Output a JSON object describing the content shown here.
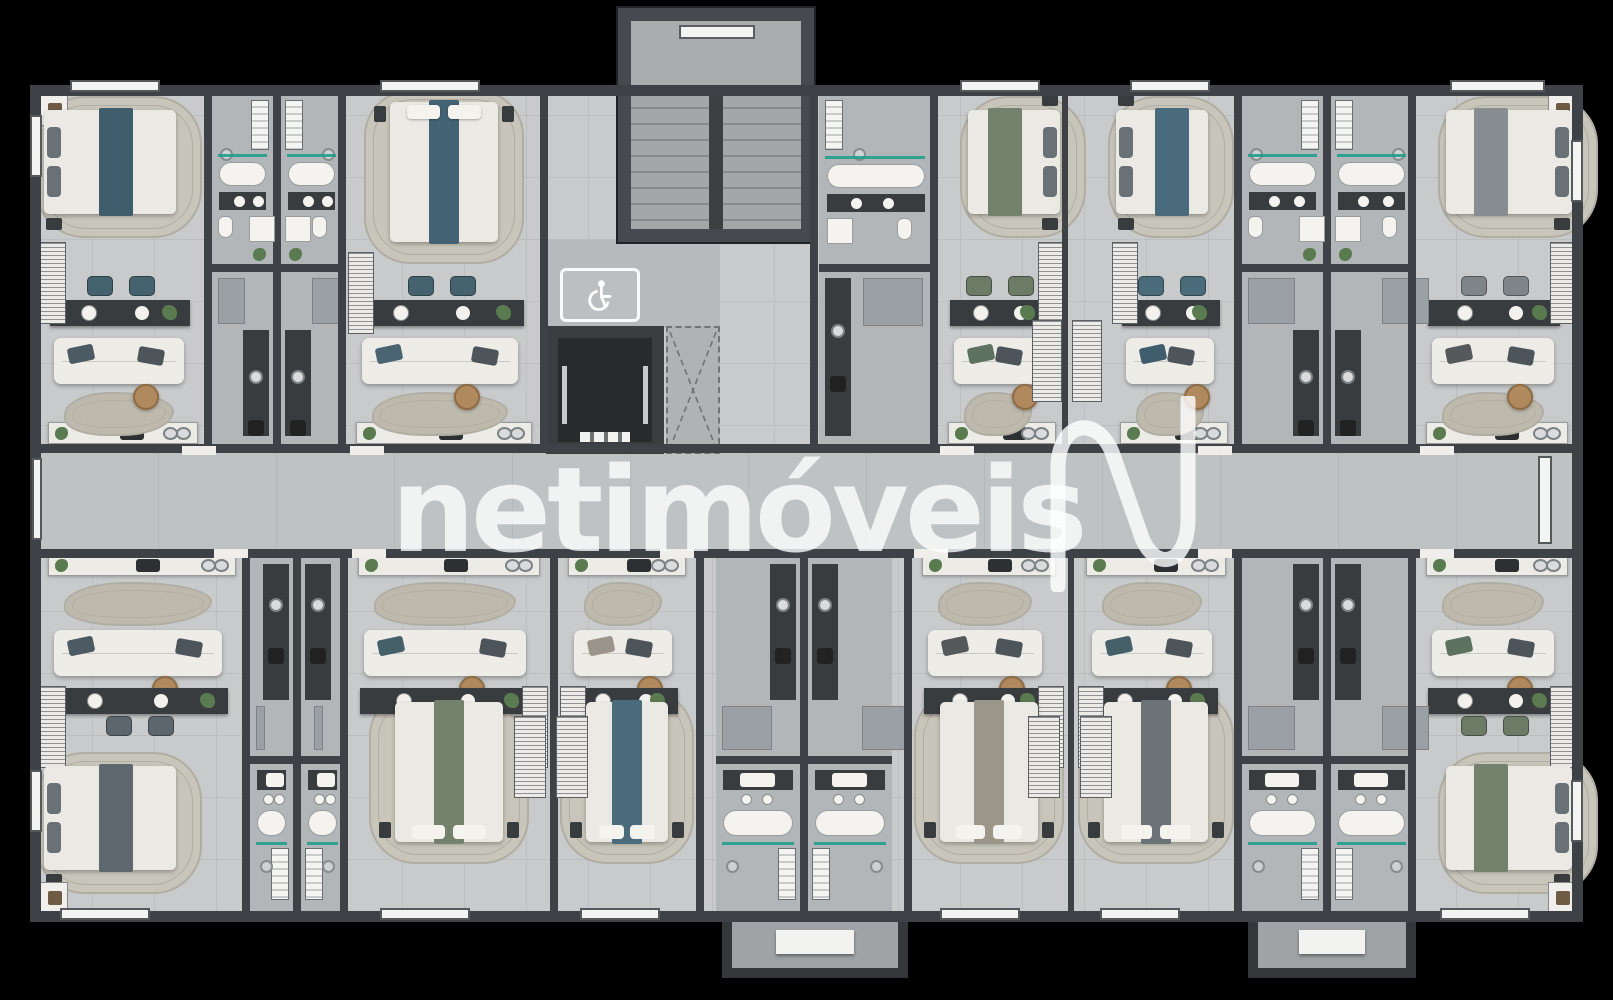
{
  "watermark": {
    "text": "netimóveis",
    "logo": "netimoveis-n-wave-logo"
  },
  "signs": {
    "accessibility": {
      "icon": "wheelchair-icon"
    }
  },
  "building": {
    "stairwell": "stairwell",
    "elevator": "elevator-shaft",
    "shaft": "service-duct",
    "corridor": "central-corridor",
    "entry_canopies": 2
  },
  "colors": {
    "background": "#000000",
    "floor": "#c8cacb",
    "corridor_floor": "#bfc2c3",
    "core_floor": "#b2b6b8",
    "wall": "#3e4246",
    "outer_wall": "#33373a",
    "counter_dark": "#393c3f",
    "furniture_white": "#edece7",
    "duvet_white": "#eae9e3",
    "rug_beige": "#c8c5ba",
    "rug_ring": "#b0ada2",
    "wavy_rug": "#bdb9ad",
    "glass_teal": "#1f9e8c",
    "wood": "#b08a5e",
    "plant_green": "#5a7a50",
    "appliance_gray": "#9aa0a3",
    "shaft_dark": "#282b2d",
    "watermark_white": "#ffffff"
  },
  "units": [
    {
      "id": "A",
      "row": "top",
      "position": "corner-left",
      "bed_accent": "#3f5d6d",
      "pillow_accent": "#4b5a63",
      "chair_accent": "#45626f"
    },
    {
      "id": "B",
      "row": "top",
      "position": "inner",
      "bed_accent": "#436273",
      "pillow_accent": "#4b6474",
      "chair_accent": "#45626f"
    },
    {
      "id": "C",
      "row": "top",
      "position": "inner",
      "bed_accent": "#74826d",
      "pillow_accent": "#5d7260",
      "chair_accent": "#6c7b66"
    },
    {
      "id": "D",
      "row": "top",
      "position": "inner",
      "bed_accent": "#496b7c",
      "pillow_accent": "#3f5d6d",
      "chair_accent": "#4a6b7a"
    },
    {
      "id": "E",
      "row": "top",
      "position": "corner-right",
      "bed_accent": "#878d91",
      "pillow_accent": "#55595c",
      "chair_accent": "#7e8488"
    },
    {
      "id": "F",
      "row": "bottom",
      "position": "corner-left",
      "bed_accent": "#5f686e",
      "pillow_accent": "#4b5a63",
      "chair_accent": "#5d666c"
    },
    {
      "id": "G",
      "row": "bottom",
      "position": "inner",
      "bed_accent": "#74826d",
      "pillow_accent": "#46606a",
      "chair_accent": "#6c7b66"
    },
    {
      "id": "H",
      "row": "bottom",
      "position": "inner",
      "bed_accent": "#496b7c",
      "pillow_accent": "#9b948a",
      "chair_accent": "#4a6b7a"
    },
    {
      "id": "I",
      "row": "bottom",
      "position": "inner",
      "bed_accent": "#9a968a",
      "pillow_accent": "#55595c",
      "chair_accent": "#8a867a"
    },
    {
      "id": "J",
      "row": "bottom",
      "position": "inner",
      "bed_accent": "#6b7278",
      "pillow_accent": "#46606a",
      "chair_accent": "#646b71"
    },
    {
      "id": "K",
      "row": "bottom",
      "position": "corner-right",
      "bed_accent": "#74826d",
      "pillow_accent": "#5d7260",
      "chair_accent": "#6c7b66"
    }
  ]
}
